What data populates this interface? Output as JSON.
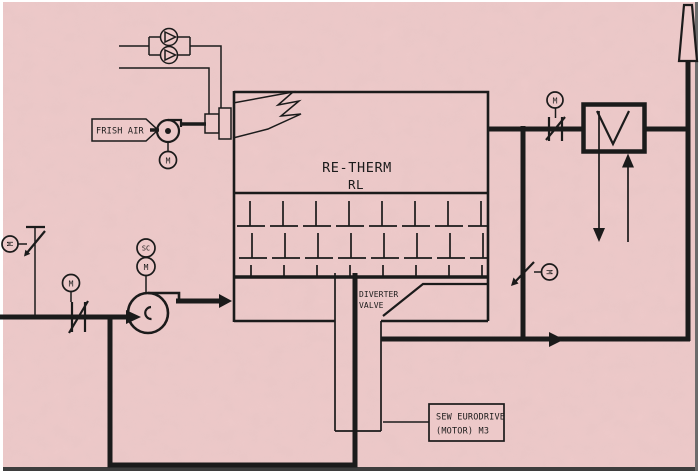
{
  "diagram": {
    "background_color": "#edc9c9",
    "line_color": "#1b1b1b",
    "frame_bottom_color": "#3d3d3d",
    "frame_right_color": "#6b6b6b",
    "labels": {
      "fresh_air": "FRISH AIR",
      "unit_name": "RE-THERM",
      "unit_model": "RL",
      "diverter_line1": "DIVERTER",
      "diverter_line2": "VALVE",
      "drive_line1": "SEW EURODRIVE",
      "drive_line2": "(MOTOR) M3",
      "motor": "M",
      "speed_control": "SC"
    }
  }
}
